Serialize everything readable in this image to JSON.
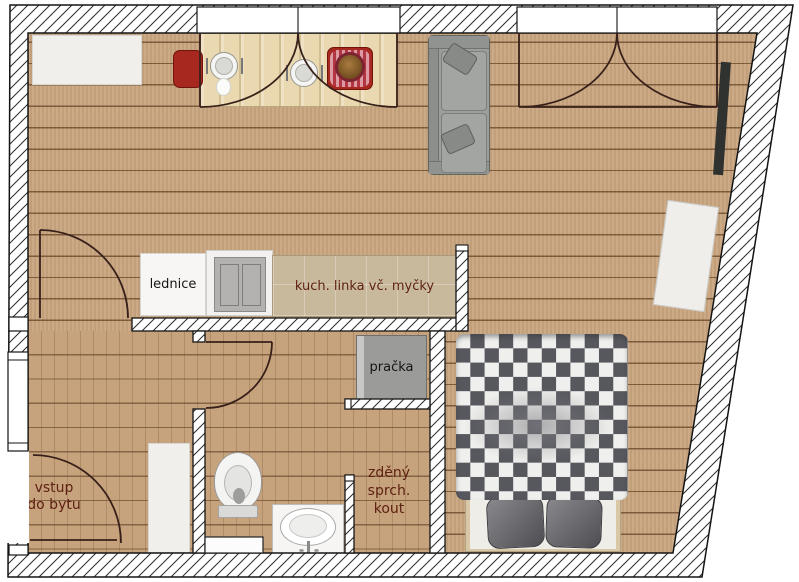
{
  "title": "apartment floor plan",
  "canvas": {
    "width": 799,
    "height": 582
  },
  "labels": {
    "fridge": "lednice",
    "kitchen": "kuch. linka vč. myčky",
    "washer": "pračka",
    "entrance_line1": "vstup",
    "entrance_line2": "do bytu",
    "shower_line1": "zděný",
    "shower_line2": "sprch.",
    "shower_line3": "kout"
  },
  "colors": {
    "floor": "#c9a57f",
    "plank_line": "#704f32",
    "label_brown": "#5e2113",
    "label_black": "#161616",
    "chair_red": "#a7281f",
    "sofa_gray": "#9b9e9a",
    "washer_gray": "#9b9b99",
    "blanket_dark": "#57585e",
    "blanket_light": "#efefed",
    "wall_line": "#141414",
    "door_arc": "#38201a",
    "table_wood": "#ead9b0"
  }
}
